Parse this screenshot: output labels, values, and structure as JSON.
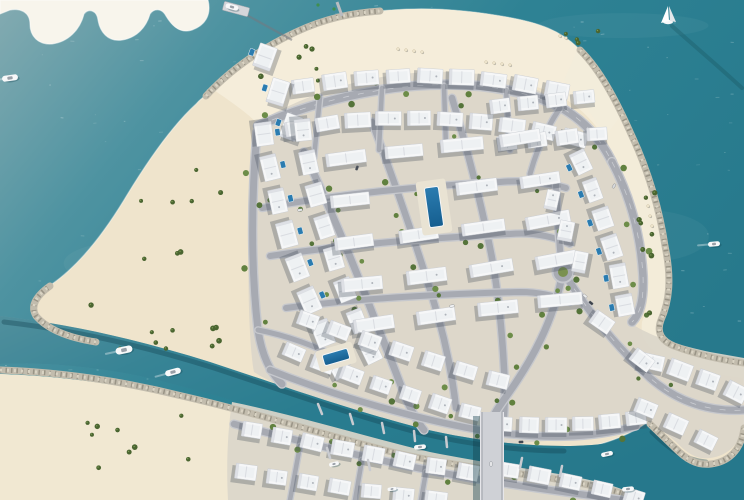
{
  "scene": {
    "description": "aerial-render-island-residential-masterplan",
    "canvas": {
      "w": 744,
      "h": 500
    }
  },
  "palette": {
    "waterLight": "#84abb1",
    "waterMid": "#3f8c9c",
    "waterDeep": "#27798c",
    "waterEdge": "#2e8294",
    "sand": "#efe4cc",
    "sandBright": "#f4edda",
    "sandWhite": "#f8f5ec",
    "sandLower": "#f1e8d2",
    "pad": "#dbd6ca",
    "road": "#a7aab2",
    "roadCurb": "#c6c8cd",
    "roadDash": "#e8e9ec",
    "rock": "#c2bcad",
    "rockDark": "#8f8a7c",
    "rockLight": "#dad4c4",
    "villa": "#f6f7f8",
    "villaInner": "#edeff2",
    "villaEdge": "#c5cad1",
    "villaStroke": "#c6cad0",
    "shadow": "#3f4a57",
    "waterShadow": "#113f4c",
    "poolBlue": "#2b7cb0",
    "poolDeep": "#155e8f",
    "deck": "#e9e3d3",
    "treeA": "#55743a",
    "treeB": "#61813f",
    "treeC": "#6d8d49",
    "palm": "#4a6530",
    "boatWhite": "#f7f8f9",
    "boatGray": "#9aa0a8",
    "bridgeDeck": "#cfd1d6",
    "green": "#7a9150",
    "buoy": "#3f8f4f",
    "umbrella": "#efe6cf"
  },
  "water": {
    "speckleCount": 260,
    "speckleSeed": 42
  },
  "land": {
    "main": "M 214,90 C 240,62 268,44 300,30 C 330,17 356,12 392,10 C 430,7 470,10 512,18 C 538,23 560,30 578,48 C 598,68 615,98 630,132 C 648,170 659,210 664,244 C 671,278 668,300 660,318 C 655,332 660,340 672,345 C 696,354 720,359 744,362 L 744,428 C 741,452 728,462 712,464 C 696,466 684,458 674,448 L 648,422 C 622,440 592,448 560,452 L 500,456 C 440,456 380,438 322,418 C 276,400 232,382 186,366 C 140,351 100,346 74,340 C 52,335 38,326 34,312 C 32,300 40,292 52,284 C 78,266 102,236 124,200 C 148,160 172,126 196,104 C 202,97 208,94 214,90 Z",
    "spit": "M 0,0 L 208,0 C 212,16 204,26 192,30 C 180,34 172,26 166,16 C 162,8 154,8 150,14 C 146,28 136,38 122,40 C 108,42 100,32 98,20 C 97,10 88,8 84,14 C 80,30 68,42 52,44 C 38,45 30,36 30,24 C 30,12 20,8 10,10 L 0,14 Z",
    "lower": "M 0,374 C 60,376 120,384 180,398 C 250,414 320,436 390,454 C 450,468 510,472 560,480 C 595,486 620,492 640,500 L 0,500 Z",
    "canal": "M 0,316 C 70,324 140,340 210,362 C 280,385 350,410 420,428 C 470,440 520,446 565,446 C 605,446 635,440 656,428 L 676,448 C 688,460 700,466 714,464 C 730,462 742,450 744,428 L 744,500 L 624,500 C 600,488 570,482 530,474 C 470,462 410,450 350,434 C 280,415 210,392 140,376 C 90,366 40,362 0,364 Z"
  },
  "beaches": [
    {
      "d": "M 214,90 C 240,62 268,44 300,30 C 330,17 356,12 392,10 C 430,7 470,10 512,18 C 538,23 560,30 578,48 C 598,68 612,92 622,114 L 604,138 C 588,112 566,96 540,88 C 500,74 452,70 410,76 C 360,82 310,96 276,116 L 258,124 C 244,110 228,100 214,90 Z",
      "fill": "#f4edda",
      "op": 0.95
    },
    {
      "d": "M 578,48 C 598,68 615,98 630,132 C 648,170 659,210 664,244 C 671,278 668,300 660,318 C 655,332 660,340 672,345 C 696,354 720,359 744,362 L 744,378 C 710,374 684,366 662,356 C 648,348 640,338 642,322 C 650,300 650,274 644,246 C 636,206 622,168 604,136 C 592,114 580,96 564,80 Z",
      "fill": "#f3ecda",
      "op": 0.9
    },
    {
      "d": "M 0,374 C 60,376 120,384 180,398 L 232,410 C 228,440 226,470 228,500 L 0,500 Z",
      "fill": "#f1e8d2",
      "op": 1
    }
  ],
  "pads": [
    "M 258,122 C 320,86 380,74 430,72 C 480,70 524,80 552,98 C 576,114 596,140 612,172 C 632,210 642,248 644,280 C 646,302 640,316 632,324 C 650,336 680,346 710,352 L 744,358 L 744,424 C 740,446 726,456 710,458 C 696,460 686,452 676,442 L 650,420 C 624,432 594,438 562,440 L 502,444 C 446,444 390,428 334,408 C 296,394 266,380 254,372 C 246,330 246,180 258,122 Z",
    "M 232,402 C 300,416 370,438 430,452 C 490,464 540,470 580,478 C 610,484 628,490 638,498 L 636,500 L 228,500 C 226,462 228,428 232,402 Z"
  ],
  "rocksPre": [
    "M 206,96 C 232,68 262,48 296,32 C 326,18 352,13 380,11",
    "M 580,50 C 600,70 616,100 631,134 C 649,172 660,212 665,246 C 672,280 669,302 661,320 C 656,333 662,341 674,346 C 698,355 722,360 744,363"
  ],
  "rocksPost": [
    "M 96,342 C 70,338 48,330 36,316 C 30,306 36,296 50,286",
    "M 744,428 C 741,452 727,462 711,464 C 696,466 685,458 675,448 L 650,424",
    "M 0,370 C 60,372 122,381 182,396 C 252,412 322,434 392,452 C 452,466 512,472 562,480 C 598,486 622,492 640,500"
  ],
  "canalShadows": [
    "M 4,322 C 74,330 144,346 214,368 C 284,391 354,416 424,434 C 472,445 522,451 564,451",
    "M 652,432 C 668,448 684,460 706,462",
    "M 560,484 C 600,492 624,498 640,504"
  ],
  "roads": [
    {
      "d": "M 258,126 C 330,94 400,86 430,85 C 490,82 540,95 565,110 C 588,124 602,142 612,162",
      "w": 8,
      "dash": true,
      "trees": true
    },
    {
      "d": "M 612,162 C 632,200 641,240 643,276 C 644,300 640,314 632,322",
      "w": 7.5,
      "dash": true,
      "trees": true
    },
    {
      "d": "M 257,132 C 251,200 251,270 258,330 C 262,356 270,372 282,384",
      "w": 7,
      "trees": true
    },
    {
      "d": "M 304,152 C 330,208 352,260 372,312 C 382,338 394,366 404,394 C 410,408 416,420 424,430",
      "w": 7,
      "trees": true
    },
    {
      "d": "M 372,122 C 394,180 414,238 432,296 C 444,334 452,372 456,408",
      "w": 6.5,
      "trees": true
    },
    {
      "d": "M 452,98 C 468,152 482,206 492,258 C 498,292 502,330 504,368 C 505,386 505,402 504,416",
      "w": 6.5,
      "trees": true
    },
    {
      "d": "M 262,208 C 340,194 420,186 500,182 C 524,180 546,182 566,188",
      "w": 6,
      "trees": true
    },
    {
      "d": "M 270,256 C 350,244 430,238 510,234 C 532,232 552,236 570,244",
      "w": 6,
      "trees": true
    },
    {
      "d": "M 286,308 C 360,298 440,294 520,292 C 540,292 556,296 570,302",
      "w": 6,
      "trees": true
    },
    {
      "d": "M 566,276 C 588,312 618,348 650,378 C 680,404 712,412 744,410",
      "w": 7,
      "dash": true,
      "trees": true
    },
    {
      "d": "M 562,272 C 559,240 557,212 556,184",
      "w": 6
    },
    {
      "d": "M 562,276 C 553,322 532,360 508,394 C 498,408 492,416 490,426",
      "w": 7,
      "trees": true
    },
    {
      "d": "M 270,370 C 340,398 420,420 490,432 C 540,438 588,440 636,426",
      "w": 6.5,
      "trees": true
    },
    {
      "d": "M 490,426 L 491,500",
      "w": 9
    },
    {
      "d": "M 234,424 C 310,444 390,464 470,478 C 530,488 580,494 622,500",
      "w": 6.5,
      "trees": true
    },
    {
      "d": "M 300,446 L 290,500",
      "w": 4.5
    },
    {
      "d": "M 362,460 L 355,500",
      "w": 4.5
    },
    {
      "d": "M 426,472 L 421,500",
      "w": 4.5
    },
    {
      "d": "M 320,97 L 314,158",
      "w": 4.5
    },
    {
      "d": "M 382,88 L 379,150",
      "w": 4.5
    },
    {
      "d": "M 444,86 L 446,148",
      "w": 4.5
    },
    {
      "d": "M 506,90 L 510,150",
      "w": 4.5
    },
    {
      "d": "M 560,108 C 545,130 536,152 530,174",
      "w": 5
    },
    {
      "d": "M 258,330 C 290,336 320,348 348,362",
      "w": 5
    }
  ],
  "roundabout": {
    "x": 563,
    "y": 272,
    "r": 10.5,
    "innerR": 5
  },
  "villaRows": [
    {
      "s": [
        303,
        86
      ],
      "e": [
        557,
        90
      ],
      "c": [
        430,
        64
      ],
      "n": 9,
      "w": 24,
      "h": 15,
      "auto": true
    },
    {
      "s": [
        265,
        57
      ],
      "e": [
        291,
        127
      ],
      "n": 3,
      "w": 26,
      "h": 17,
      "a": -72,
      "pools": -1
    },
    {
      "s": [
        297,
        128
      ],
      "e": [
        575,
        138
      ],
      "c": [
        433,
        104
      ],
      "n": 10,
      "w": 25,
      "h": 15,
      "auto": true
    },
    {
      "s": [
        500,
        106
      ],
      "e": [
        584,
        97
      ],
      "n": 4,
      "w": 21,
      "h": 14,
      "a": -6
    },
    {
      "s": [
        507,
        143
      ],
      "e": [
        597,
        134
      ],
      "n": 4,
      "w": 21,
      "h": 14,
      "a": -6
    },
    {
      "s": [
        581,
        162
      ],
      "e": [
        625,
        305
      ],
      "c": [
        612,
        232
      ],
      "n": 6,
      "w": 23,
      "h": 16,
      "auto": true,
      "pools": 1
    },
    {
      "s": [
        264,
        134
      ],
      "e": [
        338,
        366
      ],
      "c": [
        283,
        252
      ],
      "n": 8,
      "w": 25,
      "h": 17,
      "auto": true,
      "pools": -1
    },
    {
      "s": [
        303,
        130
      ],
      "e": [
        371,
        352
      ],
      "c": [
        321,
        244
      ],
      "n": 8,
      "w": 23,
      "h": 16,
      "auto": true
    },
    {
      "s": [
        346,
        158
      ],
      "e": [
        520,
        138
      ],
      "n": 4,
      "w": 40,
      "h": 13,
      "a": -8
    },
    {
      "s": [
        350,
        200
      ],
      "e": [
        540,
        180
      ],
      "n": 4,
      "w": 40,
      "h": 13,
      "a": -8,
      "skip": [
        1
      ]
    },
    {
      "s": [
        354,
        242
      ],
      "e": [
        548,
        220
      ],
      "n": 4,
      "w": 42,
      "h": 13,
      "a": -8
    },
    {
      "s": [
        362,
        284
      ],
      "e": [
        556,
        260
      ],
      "n": 4,
      "w": 42,
      "h": 13,
      "a": -8
    },
    {
      "s": [
        374,
        324
      ],
      "e": [
        560,
        300
      ],
      "n": 4,
      "w": 42,
      "h": 13,
      "a": -8
    },
    {
      "s": [
        552,
        200
      ],
      "e": [
        580,
        262
      ],
      "n": 3,
      "w": 20,
      "h": 14,
      "a": -78
    },
    {
      "s": [
        294,
        352
      ],
      "e": [
        470,
        412
      ],
      "c": [
        380,
        388
      ],
      "n": 7,
      "w": 21,
      "h": 15,
      "auto": true
    },
    {
      "s": [
        308,
        320
      ],
      "e": [
        498,
        380
      ],
      "c": [
        400,
        352
      ],
      "n": 7,
      "w": 21,
      "h": 15,
      "auto": true
    },
    {
      "s": [
        502,
        424
      ],
      "e": [
        636,
        418
      ],
      "c": [
        570,
        428
      ],
      "n": 6,
      "w": 21,
      "h": 15,
      "auto": true
    },
    {
      "s": [
        652,
        362
      ],
      "e": [
        736,
        392
      ],
      "c": [
        694,
        372
      ],
      "n": 4,
      "w": 23,
      "h": 16,
      "auto": true
    },
    {
      "s": [
        646,
        408
      ],
      "e": [
        706,
        440
      ],
      "n": 3,
      "w": 22,
      "h": 15,
      "a": 25
    },
    {
      "s": [
        252,
        430
      ],
      "e": [
        468,
        472
      ],
      "c": [
        356,
        452
      ],
      "n": 8,
      "w": 21,
      "h": 15,
      "auto": true
    },
    {
      "s": [
        246,
        472
      ],
      "e": [
        436,
        499
      ],
      "c": [
        338,
        488
      ],
      "n": 7,
      "w": 21,
      "h": 15,
      "auto": true
    },
    {
      "s": [
        508,
        470
      ],
      "e": [
        634,
        497
      ],
      "c": [
        570,
        480
      ],
      "n": 5,
      "w": 21,
      "h": 15,
      "auto": true
    },
    {
      "s": [
        602,
        322
      ],
      "e": [
        642,
        360
      ],
      "n": 2,
      "w": 22,
      "h": 15,
      "a": 35
    }
  ],
  "pools": [
    {
      "x": 434,
      "y": 207,
      "w": 14,
      "h": 40,
      "a": -8,
      "deckW": 30,
      "deckH": 54
    },
    {
      "x": 336,
      "y": 357,
      "w": 26,
      "h": 11,
      "a": -16,
      "deckW": 38,
      "deckH": 22
    }
  ],
  "palmRegions": [
    {
      "x": 85,
      "y": 165,
      "w": 140,
      "h": 190,
      "n": 14
    },
    {
      "x": 238,
      "y": 42,
      "w": 80,
      "h": 55,
      "n": 6
    },
    {
      "x": 25,
      "y": 405,
      "w": 170,
      "h": 80,
      "n": 9
    },
    {
      "x": 630,
      "y": 175,
      "w": 26,
      "h": 140,
      "n": 8
    },
    {
      "x": 555,
      "y": 28,
      "w": 55,
      "h": 28,
      "n": 4
    },
    {
      "x": 150,
      "y": 322,
      "w": 70,
      "h": 26,
      "n": 4
    }
  ],
  "bridge": {
    "x": 480,
    "y": 412,
    "w": 24,
    "h": 88
  },
  "piers": {
    "nwPier": {
      "x": 236,
      "y": 9,
      "w": 26,
      "h": 9,
      "a": 15
    },
    "jetty": "M 243,13 L 292,40",
    "topJetty": "M 342,16 L 337,2",
    "docks": [
      [
        318,
        404,
        322,
        414
      ],
      [
        350,
        414,
        353,
        424
      ],
      [
        382,
        423,
        384,
        433
      ],
      [
        414,
        431,
        415,
        441
      ],
      [
        446,
        437,
        447,
        447
      ],
      [
        330,
        458,
        327,
        448
      ],
      [
        370,
        470,
        368,
        460
      ],
      [
        520,
        468,
        522,
        458
      ],
      [
        560,
        476,
        562,
        466
      ]
    ]
  },
  "sailboat": {
    "x": 668,
    "y": 16,
    "wake": "M 672,26 C 692,44 716,64 742,88"
  },
  "boats": [
    {
      "x": 10,
      "y": 78,
      "l": 16,
      "w": 6,
      "a": -8,
      "wake": true
    },
    {
      "x": 124,
      "y": 350,
      "l": 17,
      "w": 7,
      "a": -12,
      "wake": true
    },
    {
      "x": 173,
      "y": 372,
      "l": 16,
      "w": 6,
      "a": -15,
      "wake": true
    },
    {
      "x": 232,
      "y": 7,
      "l": 13,
      "w": 5,
      "a": 15
    },
    {
      "x": 714,
      "y": 244,
      "l": 12,
      "w": 5,
      "a": -5,
      "wake": true
    },
    {
      "x": 420,
      "y": 447,
      "l": 12,
      "w": 4.5,
      "a": -6
    },
    {
      "x": 334,
      "y": 464,
      "l": 10,
      "w": 4,
      "a": -14
    },
    {
      "x": 607,
      "y": 454,
      "l": 12,
      "w": 4.5,
      "a": -12
    },
    {
      "x": 628,
      "y": 489,
      "l": 12,
      "w": 4.5,
      "a": -6
    },
    {
      "x": 392,
      "y": 489,
      "l": 9,
      "w": 3.5,
      "a": -8
    }
  ],
  "cars": [
    {
      "x": 585,
      "y": 296,
      "a": 40,
      "c": "#eceded"
    },
    {
      "x": 591,
      "y": 303,
      "a": 40,
      "c": "#3c424b"
    },
    {
      "x": 300,
      "y": 210,
      "a": -8,
      "c": "#e8e9eb"
    },
    {
      "x": 357,
      "y": 168,
      "a": -70,
      "c": "#474d56"
    },
    {
      "x": 452,
      "y": 306,
      "a": -12,
      "c": "#f0f1f2"
    },
    {
      "x": 521,
      "y": 442,
      "a": -4,
      "c": "#3f454e"
    },
    {
      "x": 491,
      "y": 464,
      "a": -90,
      "c": "#e9eaec"
    },
    {
      "x": 614,
      "y": 186,
      "a": -60,
      "c": "#d7d9dc"
    }
  ],
  "buoys": [
    {
      "x": 318,
      "y": 5
    },
    {
      "x": 334,
      "y": 9
    }
  ],
  "umbrellas": [
    [
      398,
      49
    ],
    [
      406,
      50
    ],
    [
      414,
      51
    ],
    [
      422,
      52
    ],
    [
      486,
      62
    ],
    [
      494,
      63
    ],
    [
      502,
      64
    ],
    [
      510,
      65
    ],
    [
      560,
      36
    ],
    [
      566,
      38
    ],
    [
      648,
      206
    ],
    [
      650,
      216
    ],
    [
      652,
      226
    ]
  ]
}
